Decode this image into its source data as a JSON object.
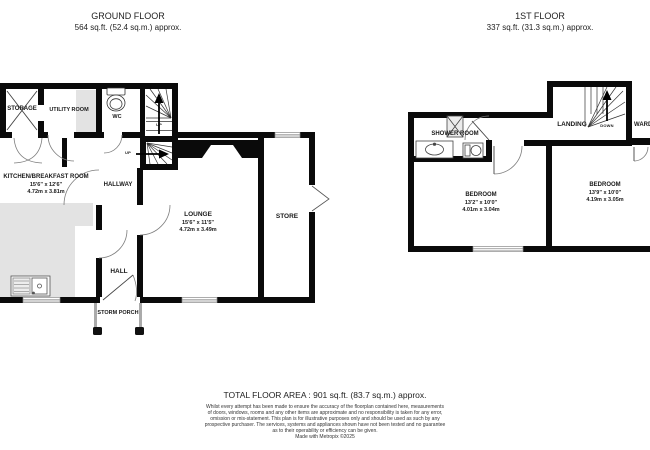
{
  "ground_floor": {
    "title": "GROUND FLOOR",
    "area": "564 sq.ft. (52.4 sq.m.) approx.",
    "rooms": {
      "storage": {
        "name": "STORAGE"
      },
      "utility": {
        "name": "UTILITY ROOM"
      },
      "wc": {
        "name": "WC"
      },
      "kitchen": {
        "name": "KITCHEN/BREAKFAST ROOM",
        "imperial": "15'6\" x 12'6\"",
        "metric": "4.72m x 3.81m"
      },
      "hallway": {
        "name": "HALLWAY"
      },
      "lounge": {
        "name": "LOUNGE",
        "imperial": "15'6\" x 11'5\"",
        "metric": "4.72m x 3.49m"
      },
      "store": {
        "name": "STORE"
      },
      "hall": {
        "name": "HALL"
      },
      "storm_porch": {
        "name": "STORM PORCH"
      },
      "stairs_up_1": "UP",
      "stairs_up_2": "UP"
    }
  },
  "first_floor": {
    "title": "1ST FLOOR",
    "area": "337 sq.ft. (31.3 sq.m.) approx.",
    "rooms": {
      "shower_room": {
        "name": "SHOWER ROOM"
      },
      "landing": {
        "name": "LANDING"
      },
      "stairs_down": "DOWN",
      "wardrobe": {
        "name": "WARDROBE"
      },
      "bedroom1": {
        "name": "BEDROOM",
        "imperial": "13'2\" x 10'0\"",
        "metric": "4.01m x 3.04m"
      },
      "bedroom2": {
        "name": "BEDROOM",
        "imperial": "13'9\" x 10'0\"",
        "metric": "4.19m x 3.05m"
      }
    }
  },
  "footer": {
    "total_area": "TOTAL FLOOR AREA : 901 sq.ft. (83.7 sq.m.) approx.",
    "disclaimer_lines": [
      "Whilst every attempt has been made to ensure the accuracy of the floorplan contained here, measurements",
      "of doors, windows, rooms and any other items are approximate and no responsibility is taken for any error,",
      "omission or mis-statement. This plan is for illustrative purposes only and should be used as such by any",
      "prospective purchaser. The services, systems and appliances shown have not been tested and no guarantee",
      "as to their operability or efficiency can be given.",
      "Made with Metropix ©2025"
    ]
  },
  "colors": {
    "wall": "#0a0a0a",
    "counter": "#e3e3e3",
    "text": "#1a1a1a"
  }
}
